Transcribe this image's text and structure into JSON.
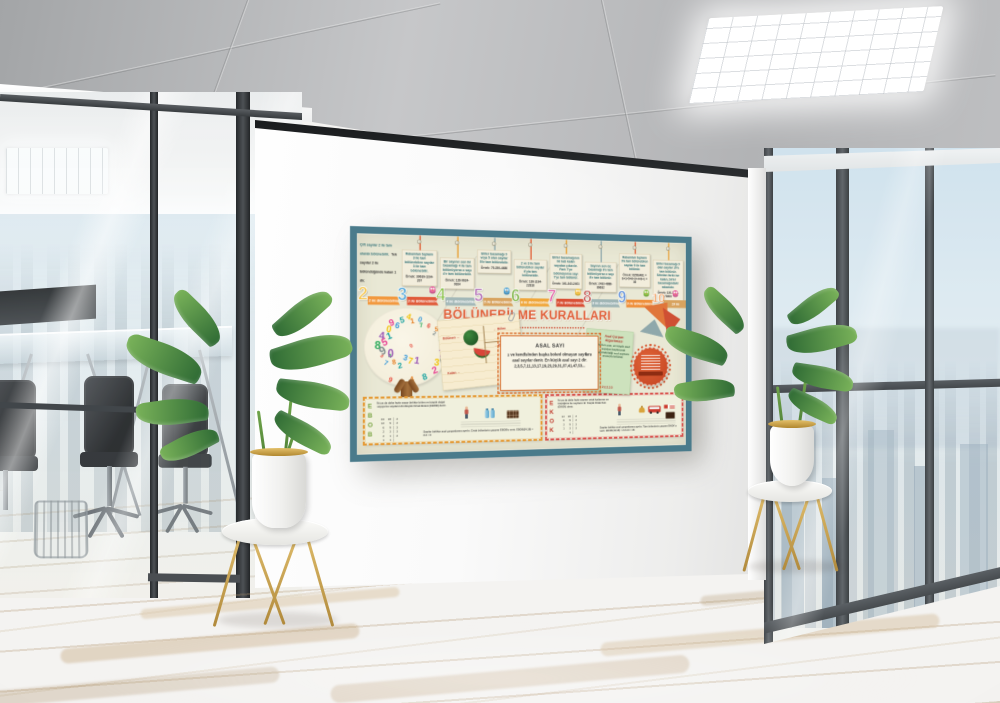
{
  "scene_label": "Office interior with educational wall poster",
  "icons": [
    "number-tree-icon",
    "watermelon-icon",
    "paperclip-icon",
    "owl-icon",
    "scissors-arrow-icon",
    "seal-badge-icon",
    "person-icon",
    "water-jug-icon",
    "chocolate-icon",
    "bell-icon",
    "bus-icon",
    "flag-icon",
    "plant-icon",
    "ceiling-light-icon"
  ],
  "colors": {
    "poster_frame": "#4a7b8b",
    "poster_bg": "#e9e8d5",
    "title": "#e1603a",
    "ebob_letters": "#76a23e",
    "ekok_letters": "#c0392b"
  },
  "poster": {
    "title": "BÖLÜNEBİLME KURALLARI",
    "rule2": {
      "text1": "Çift sayılar 2 ile tam olarak bölünebilir.",
      "text2": "Tek sayılar 2 ile bölündüğünde kalan 1 dir."
    },
    "cards": [
      {
        "num": "3",
        "text": "Rakamları toplamı 3 ile tam bölünebilen sayılar 3 ile tam bölünebilir.",
        "example": "Örnek: 39639-1194-207"
      },
      {
        "num": "4",
        "text": "Bir sayının son iki basamağı 4 ile tam bölünüyorsa o sayı 4'e tam bölünebilir.",
        "example": "Örnek: 128-9624-9924"
      },
      {
        "num": "5",
        "text": "Birler basamağı 0 veya 5 olan sayılar 5'le tam bölünebilir.",
        "example": "Örnek: 75-250-4680"
      },
      {
        "num": "6",
        "text": "2 ve 3 ile tam bölünebilen sayılar 6'yla tam bölünebilir.",
        "example": "Örnek: 138-1194-22818"
      },
      {
        "num": "7",
        "text": "Birler basamağının iki katı kalan sayıdan çıkarılır. Fark 7'ye bölünüyorsa sayı 7'ye tam bölünür.",
        "example": "Örnek: 161-343-2401"
      },
      {
        "num": "8",
        "text": "Sayının son üç basamağı 8'e tam bölünüyorsa o sayı 8'e tam bölünür.",
        "example": "Örnek: 2432-4888-86632"
      },
      {
        "num": "9",
        "text": "Rakamları toplamı 9'a tam bölünebilen sayılar 9 ile tam bölünür.",
        "example": "Örnek: 81563481 = 8+1+5+6+3+4+8+1 = 36"
      },
      {
        "num": "10",
        "text": "Birler basamağı 0 olan sayılar 10'a tam bölünür. Sıfırdan farklı ise kalan, birler basamağındaki rakamdır.",
        "example": "Örnek: 120-3450-78900"
      }
    ],
    "ribbons": [
      {
        "num": "2",
        "label": "2 ile Bölünebilme",
        "color": "#f2993f",
        "digit": "#f6c445"
      },
      {
        "num": "3",
        "label": "3 ile Bölünebilme",
        "color": "#e05a3a",
        "digit": "#4aa3d8"
      },
      {
        "num": "4",
        "label": "4 ile Bölünebilme",
        "color": "#a3b8b8",
        "digit": "#8bc34a"
      },
      {
        "num": "5",
        "label": "5 ile Bölünebilme",
        "color": "#d8a35f",
        "digit": "#b06ab3"
      },
      {
        "num": "6",
        "label": "6 ile Bölünebilme",
        "color": "#f0a73b",
        "digit": "#7cb342"
      },
      {
        "num": "7",
        "label": "7 ile Bölünebilme",
        "color": "#d94f35",
        "digit": "#e255a1"
      },
      {
        "num": "8",
        "label": "8 ile Bölünebilme",
        "color": "#9fb5b5",
        "digit": "#c2554f"
      },
      {
        "num": "9",
        "label": "9 ile Bölünebilme",
        "color": "#ef8f3a",
        "digit": "#5b8dd9"
      },
      {
        "num": "10",
        "label": "10 ile Bölünebilme",
        "color": "#d8a35f",
        "digit": "#f08c3e"
      }
    ],
    "prime": {
      "title": "ASAL SAYI",
      "text": "1 ve kendisinden başka böleni olmayan sayılara asal sayılar denir. En küçük asal sayı 2 dir. 2,3,5,7,11,13,17,19,23,29,31,37,41,47,53..."
    },
    "division_note": {
      "dividend": "Bölünen →",
      "divisor": "← Bölen",
      "quotient": "← Bölüm",
      "remainder": "Kalan →"
    },
    "algo": {
      "title": "Asal Çarpan Algoritması",
      "text": "Verilen sayı, en küçük asal sayıdan başlanarak bölünebildiği asal sayılara sırasıyla bölünür.",
      "ladder": "48 │ 2\n24 │ 2\n12 │ 2\n 6 │ 2\n 3 │ 3\n 1 │",
      "foot": "48 = 2.2.2.2.3"
    },
    "ebob": {
      "letters": "E\nB\nO\nB",
      "text1": "İki ya da daha fazla sayıyı birlikte bölen en büyük doğal sayıya bu sayıların En Büyük Ortak Böleni (EBOB) denir.",
      "ladder": "24  18 │ 2\n12   9 │ 2\n 6   9 │ 3\n 2   3 │ 3\n 2   1 │ 2\n 1   1 │",
      "text2": "Sayılar birlikte asal çarpanlarına ayrılır. Ortak bölenlerin çarpımı EBOB'u verir. EBOB(24,18) = 2.3 = 6"
    },
    "ekok": {
      "letters": "E\nK\nO\nK",
      "text1": "İki ya da daha fazla sayının ortak katlarının en küçüğüne bu sayıların En Küçük Ortak Katı (EKOK) denir.",
      "ladder": "12  18 │ 2\n 6   9 │ 2\n 3   9 │ 3\n 1   3 │ 3\n     1 │",
      "text2": "Sayılar birlikte asal çarpanlarına ayrılır. Tüm bölenlerin çarpımı EKOK'u verir. EKOK(12,18) = 2.2.3.3 = 36"
    },
    "tree": {
      "digits": "0123456789",
      "colors": [
        "#e74c3c",
        "#3b9ad9",
        "#f1c40f",
        "#9b59b6",
        "#2eab5c",
        "#e67e22",
        "#17a2a0",
        "#e84393",
        "#7f8c8d"
      ]
    }
  }
}
